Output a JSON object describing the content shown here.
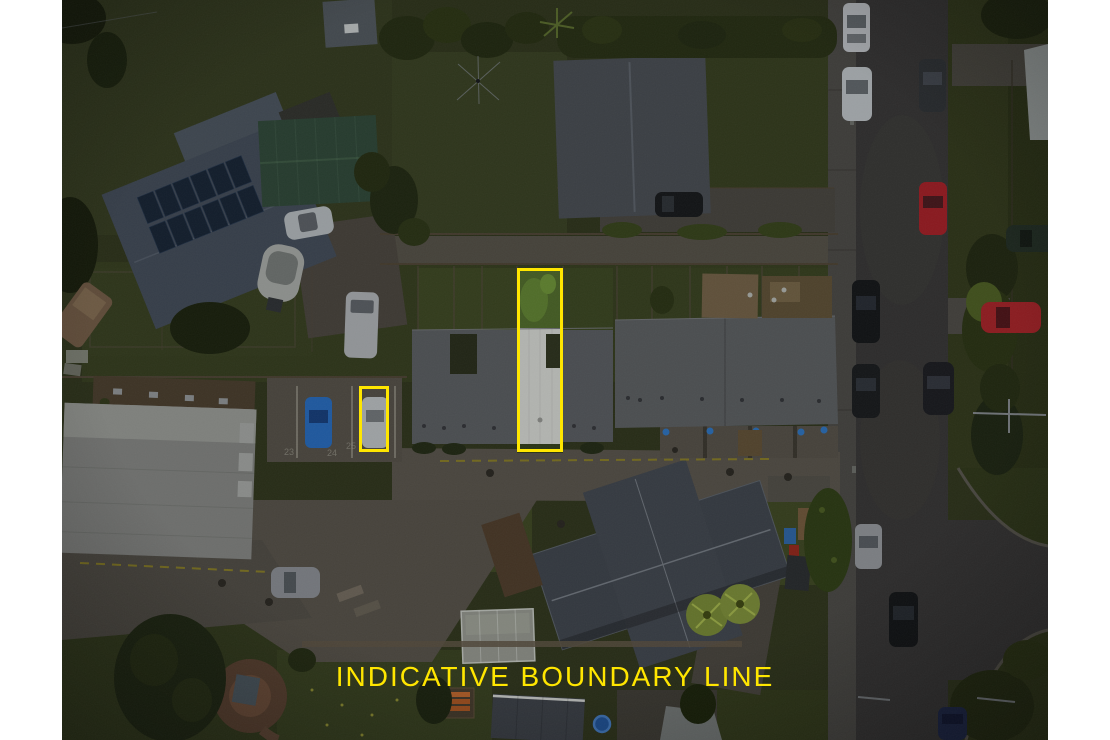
{
  "canvas": {
    "width": 1110,
    "height": 740,
    "margin_color": "#ffffff"
  },
  "photo": {
    "left": 62,
    "top": 0,
    "width": 986,
    "height": 740,
    "description": "Aerial drone photograph of residential properties, roads and parked cars at dusk"
  },
  "overlay": {
    "accent_color": "#ffe600",
    "caption": "INDICATIVE BOUNDARY LINE",
    "boundary_rects": [
      {
        "label": "unit-lot-boundary",
        "x": 455,
        "y": 268,
        "width": 46,
        "height": 184,
        "stroke_px": 3
      },
      {
        "label": "carpark-boundary",
        "x": 297,
        "y": 386,
        "width": 30,
        "height": 66,
        "stroke_px": 3
      }
    ]
  },
  "ground_markings": {
    "parking_space_numbers": [
      "23",
      "24",
      "25"
    ]
  }
}
